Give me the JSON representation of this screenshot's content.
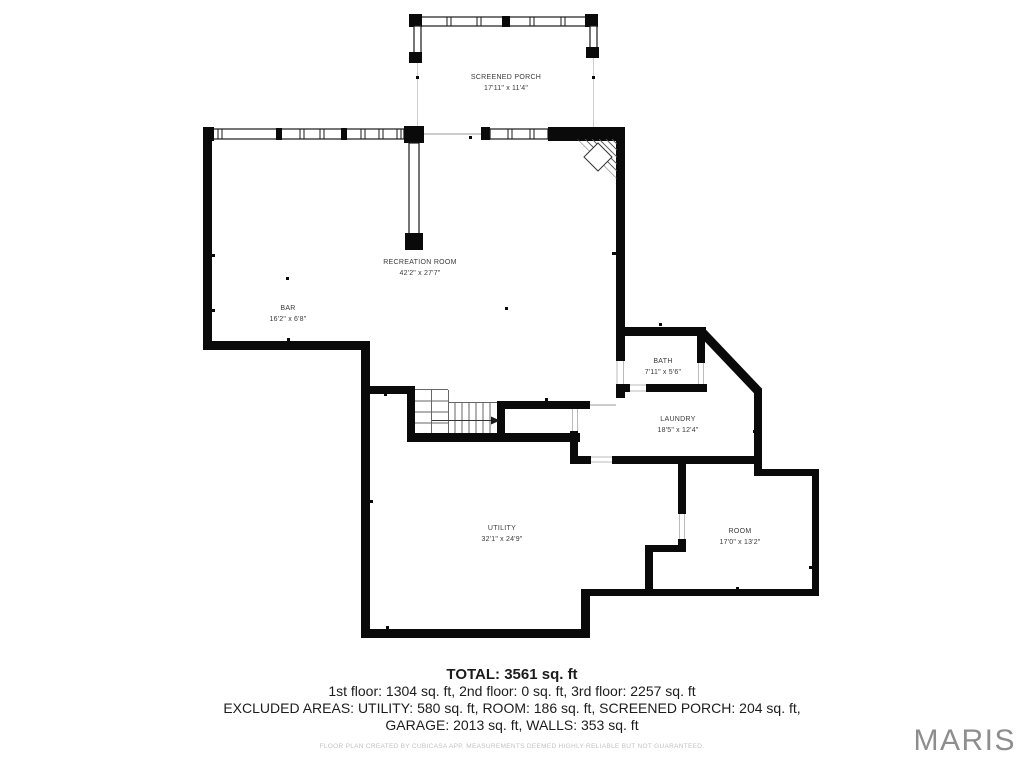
{
  "plan": {
    "rooms": {
      "screened_porch": {
        "name": "SCREENED PORCH",
        "dims": "17'11\" x 11'4\""
      },
      "recreation_room": {
        "name": "RECREATION ROOM",
        "dims": "42'2\" x 27'7\""
      },
      "bar": {
        "name": "BAR",
        "dims": "16'2\" x 6'8\""
      },
      "bath": {
        "name": "BATH",
        "dims": "7'11\" x 5'6\""
      },
      "laundry": {
        "name": "LAUNDRY",
        "dims": "18'5\" x 12'4\""
      },
      "utility": {
        "name": "UTILITY",
        "dims": "32'1\" x 24'9\""
      },
      "room": {
        "name": "ROOM",
        "dims": "17'0\" x 13'2\""
      }
    }
  },
  "summary": {
    "total": "TOTAL: 3561 sq. ft",
    "floors": "1st floor: 1304 sq. ft, 2nd floor: 0 sq. ft, 3rd floor: 2257 sq. ft",
    "excluded_line1": "EXCLUDED AREAS: UTILITY: 580 sq. ft, ROOM: 186 sq. ft, SCREENED PORCH: 204 sq. ft,",
    "excluded_line2": "GARAGE: 2013 sq. ft, WALLS: 353 sq. ft"
  },
  "footer": {
    "disclaimer": "FLOOR PLAN CREATED BY CUBICASA APP. MEASUREMENTS DEEMED HIGHLY RELIABLE BUT NOT GUARANTEED.",
    "watermark": "MARIS"
  },
  "colors": {
    "wall": "#0a0a0a",
    "label_text": "#3a3a3a",
    "watermark_gray": "#8e8e8e",
    "disclaimer_gray": "#c2c2c2"
  }
}
